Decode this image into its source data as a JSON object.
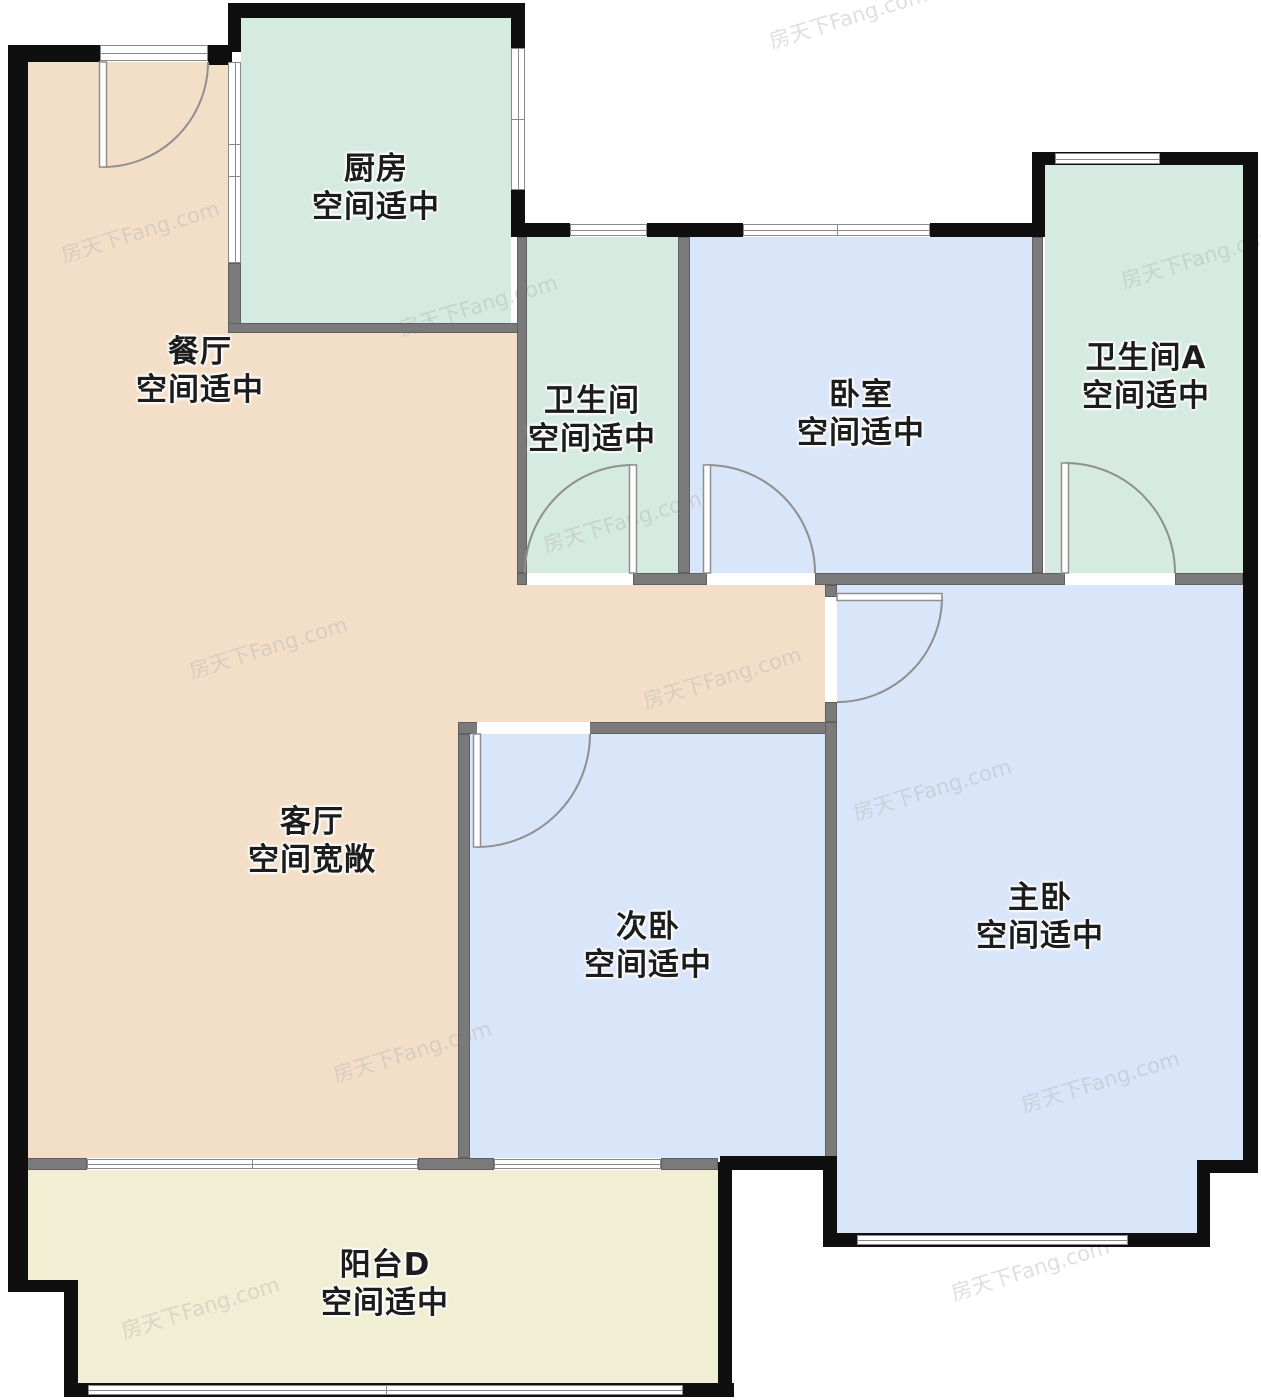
{
  "canvas": {
    "width": 1261,
    "height": 1400
  },
  "watermark": {
    "text": "房天下Fang.com"
  },
  "palette": {
    "wall_black": "#0f0f0f",
    "wall_gray": "#7a7a7a",
    "window_line": "#8a8a8a",
    "door_line": "#8f8f8f",
    "teal": "#d5eae1",
    "blue": "#d9e5f8",
    "tan": "#f3dfc8",
    "cream": "#f0eed3",
    "label": "#1c1c1c"
  },
  "rooms": [
    {
      "id": "kitchen",
      "name": "厨房",
      "status": "空间适中",
      "color": "#d5eae1",
      "label": {
        "x": 376,
        "y": 188
      },
      "rects": [
        [
          241,
          18,
          270,
          305
        ]
      ]
    },
    {
      "id": "dining",
      "name": "餐厅",
      "status": "空间适中",
      "color": "#f3dfc8",
      "label": {
        "x": 200,
        "y": 371
      },
      "rects": [
        [
          28,
          62,
          200,
          271
        ],
        [
          28,
          333,
          489,
          240
        ],
        [
          28,
          573,
          797,
          149
        ],
        [
          28,
          722,
          430,
          436
        ]
      ]
    },
    {
      "id": "bathroom",
      "name": "卫生间",
      "status": "空间适中",
      "color": "#d5eae1",
      "label": {
        "x": 592,
        "y": 420
      },
      "rects": [
        [
          527,
          237,
          151,
          336
        ]
      ]
    },
    {
      "id": "bedroom",
      "name": "卧室",
      "status": "空间适中",
      "color": "#d9e5f8",
      "label": {
        "x": 861,
        "y": 414
      },
      "rects": [
        [
          690,
          237,
          342,
          336
        ]
      ]
    },
    {
      "id": "bathroomA",
      "name": "卫生间A",
      "status": "空间适中",
      "color": "#d5eae1",
      "label": {
        "x": 1146,
        "y": 377
      },
      "rects": [
        [
          1045,
          165,
          198,
          408
        ]
      ]
    },
    {
      "id": "living",
      "name": "客厅",
      "status": "空间宽敞",
      "color": "#f3dfc8",
      "label": {
        "x": 312,
        "y": 841
      },
      "rects": []
    },
    {
      "id": "second-bedroom",
      "name": "次卧",
      "status": "空间适中",
      "color": "#d9e5f8",
      "label": {
        "x": 648,
        "y": 946
      },
      "rects": [
        [
          470,
          734,
          355,
          424
        ]
      ]
    },
    {
      "id": "master-bedroom",
      "name": "主卧",
      "status": "空间适中",
      "color": "#d9e5f8",
      "label": {
        "x": 1040,
        "y": 917
      },
      "rects": [
        [
          837,
          585,
          406,
          575
        ],
        [
          837,
          585,
          360,
          648
        ]
      ]
    },
    {
      "id": "balcony",
      "name": "阳台D",
      "status": "空间适中",
      "color": "#f0eed3",
      "label": {
        "x": 385,
        "y": 1284
      },
      "rects": [
        [
          17,
          1170,
          701,
          110
        ],
        [
          77,
          1280,
          641,
          103
        ]
      ]
    }
  ],
  "walls_black": [
    [
      228,
      3,
      297,
      15
    ],
    [
      228,
      3,
      13,
      49
    ],
    [
      511,
      3,
      14,
      46
    ],
    [
      8,
      45,
      92,
      17
    ],
    [
      208,
      45,
      24,
      20
    ],
    [
      8,
      45,
      20,
      1247
    ],
    [
      8,
      1280,
      69,
      12
    ],
    [
      64,
      1280,
      14,
      117
    ],
    [
      64,
      1383,
      670,
      14
    ],
    [
      718,
      1162,
      14,
      235
    ],
    [
      720,
      1156,
      117,
      14
    ],
    [
      823,
      1170,
      14,
      77
    ],
    [
      823,
      1233,
      387,
      14
    ],
    [
      1197,
      1160,
      13,
      87
    ],
    [
      1197,
      1160,
      60,
      13
    ],
    [
      1243,
      152,
      15,
      1021
    ],
    [
      1032,
      152,
      211,
      13
    ],
    [
      1032,
      152,
      13,
      85
    ],
    [
      511,
      190,
      14,
      47
    ],
    [
      511,
      223,
      59,
      14
    ],
    [
      647,
      223,
      96,
      14
    ],
    [
      930,
      223,
      102,
      14
    ]
  ],
  "walls_gray": [
    [
      228,
      263,
      13,
      70
    ],
    [
      228,
      323,
      297,
      10
    ],
    [
      517,
      237,
      10,
      336
    ],
    [
      678,
      237,
      12,
      336
    ],
    [
      1032,
      237,
      11,
      336
    ],
    [
      517,
      573,
      10,
      12
    ],
    [
      633,
      573,
      74,
      12
    ],
    [
      815,
      573,
      250,
      12
    ],
    [
      1175,
      573,
      68,
      12
    ],
    [
      825,
      585,
      12,
      12
    ],
    [
      825,
      702,
      12,
      20
    ],
    [
      458,
      722,
      379,
      12
    ],
    [
      825,
      722,
      12,
      436
    ],
    [
      458,
      734,
      12,
      424
    ],
    [
      17,
      1158,
      70,
      12
    ],
    [
      418,
      1158,
      76,
      12
    ],
    [
      661,
      1158,
      57,
      12
    ]
  ],
  "windows": [
    {
      "r": [
        100,
        45,
        108,
        16
      ],
      "o": "h",
      "m": []
    },
    {
      "r": [
        228,
        62,
        13,
        201
      ],
      "o": "v",
      "m": [
        143,
        175
      ]
    },
    {
      "r": [
        511,
        48,
        14,
        142
      ],
      "o": "v",
      "m": [
        118
      ]
    },
    {
      "r": [
        570,
        224,
        77,
        12
      ],
      "o": "h",
      "m": []
    },
    {
      "r": [
        743,
        224,
        187,
        12
      ],
      "o": "h",
      "m": [
        836
      ]
    },
    {
      "r": [
        1055,
        153,
        105,
        11
      ],
      "o": "h",
      "m": []
    },
    {
      "r": [
        87,
        1159,
        331,
        10
      ],
      "o": "h",
      "m": [
        251
      ]
    },
    {
      "r": [
        494,
        1159,
        167,
        10
      ],
      "o": "h",
      "m": []
    },
    {
      "r": [
        88,
        1385,
        595,
        10
      ],
      "o": "h",
      "m": [
        385
      ]
    },
    {
      "r": [
        857,
        1235,
        271,
        10
      ],
      "o": "h",
      "m": []
    }
  ],
  "openings": [
    [
      527,
      573,
      106,
      12
    ],
    [
      707,
      573,
      108,
      12
    ],
    [
      1065,
      573,
      110,
      12
    ],
    [
      825,
      597,
      12,
      105
    ],
    [
      477,
      722,
      113,
      12
    ]
  ],
  "doors": [
    {
      "id": "entry-door",
      "leaf": [
        99.5,
        62,
        7,
        105
      ],
      "arc": {
        "sx": 103,
        "sy": 167,
        "ex": 208,
        "ey": 62,
        "r": 105,
        "sweep": 0
      }
    },
    {
      "id": "bathroom-door",
      "leaf": [
        629.5,
        465,
        7,
        108
      ],
      "arc": {
        "sx": 633,
        "sy": 465,
        "ex": 525,
        "ey": 573,
        "r": 108,
        "sweep": 0
      }
    },
    {
      "id": "bedroom-door",
      "leaf": [
        703.5,
        465,
        7,
        108
      ],
      "arc": {
        "sx": 707,
        "sy": 465,
        "ex": 815,
        "ey": 573,
        "r": 108,
        "sweep": 1
      }
    },
    {
      "id": "bathroomA-door",
      "leaf": [
        1061.5,
        463,
        7,
        110
      ],
      "arc": {
        "sx": 1065,
        "sy": 463,
        "ex": 1175,
        "ey": 573,
        "r": 110,
        "sweep": 1
      }
    },
    {
      "id": "master-door",
      "leaf": [
        837,
        593.5,
        105,
        7
      ],
      "arc": {
        "sx": 942,
        "sy": 597,
        "ex": 837,
        "ey": 702,
        "r": 105,
        "sweep": 1
      }
    },
    {
      "id": "second-door",
      "leaf": [
        473.5,
        734,
        7,
        113
      ],
      "arc": {
        "sx": 477,
        "sy": 847,
        "ex": 590,
        "ey": 734,
        "r": 113,
        "sweep": 0
      }
    }
  ],
  "watermarks": [
    {
      "x": 766,
      "y": 2
    },
    {
      "x": 58,
      "y": 216
    },
    {
      "x": 396,
      "y": 290
    },
    {
      "x": 1118,
      "y": 242
    },
    {
      "x": 540,
      "y": 506
    },
    {
      "x": 186,
      "y": 632
    },
    {
      "x": 640,
      "y": 662
    },
    {
      "x": 850,
      "y": 774
    },
    {
      "x": 330,
      "y": 1036
    },
    {
      "x": 1018,
      "y": 1066
    },
    {
      "x": 118,
      "y": 1292
    },
    {
      "x": 948,
      "y": 1254
    }
  ]
}
